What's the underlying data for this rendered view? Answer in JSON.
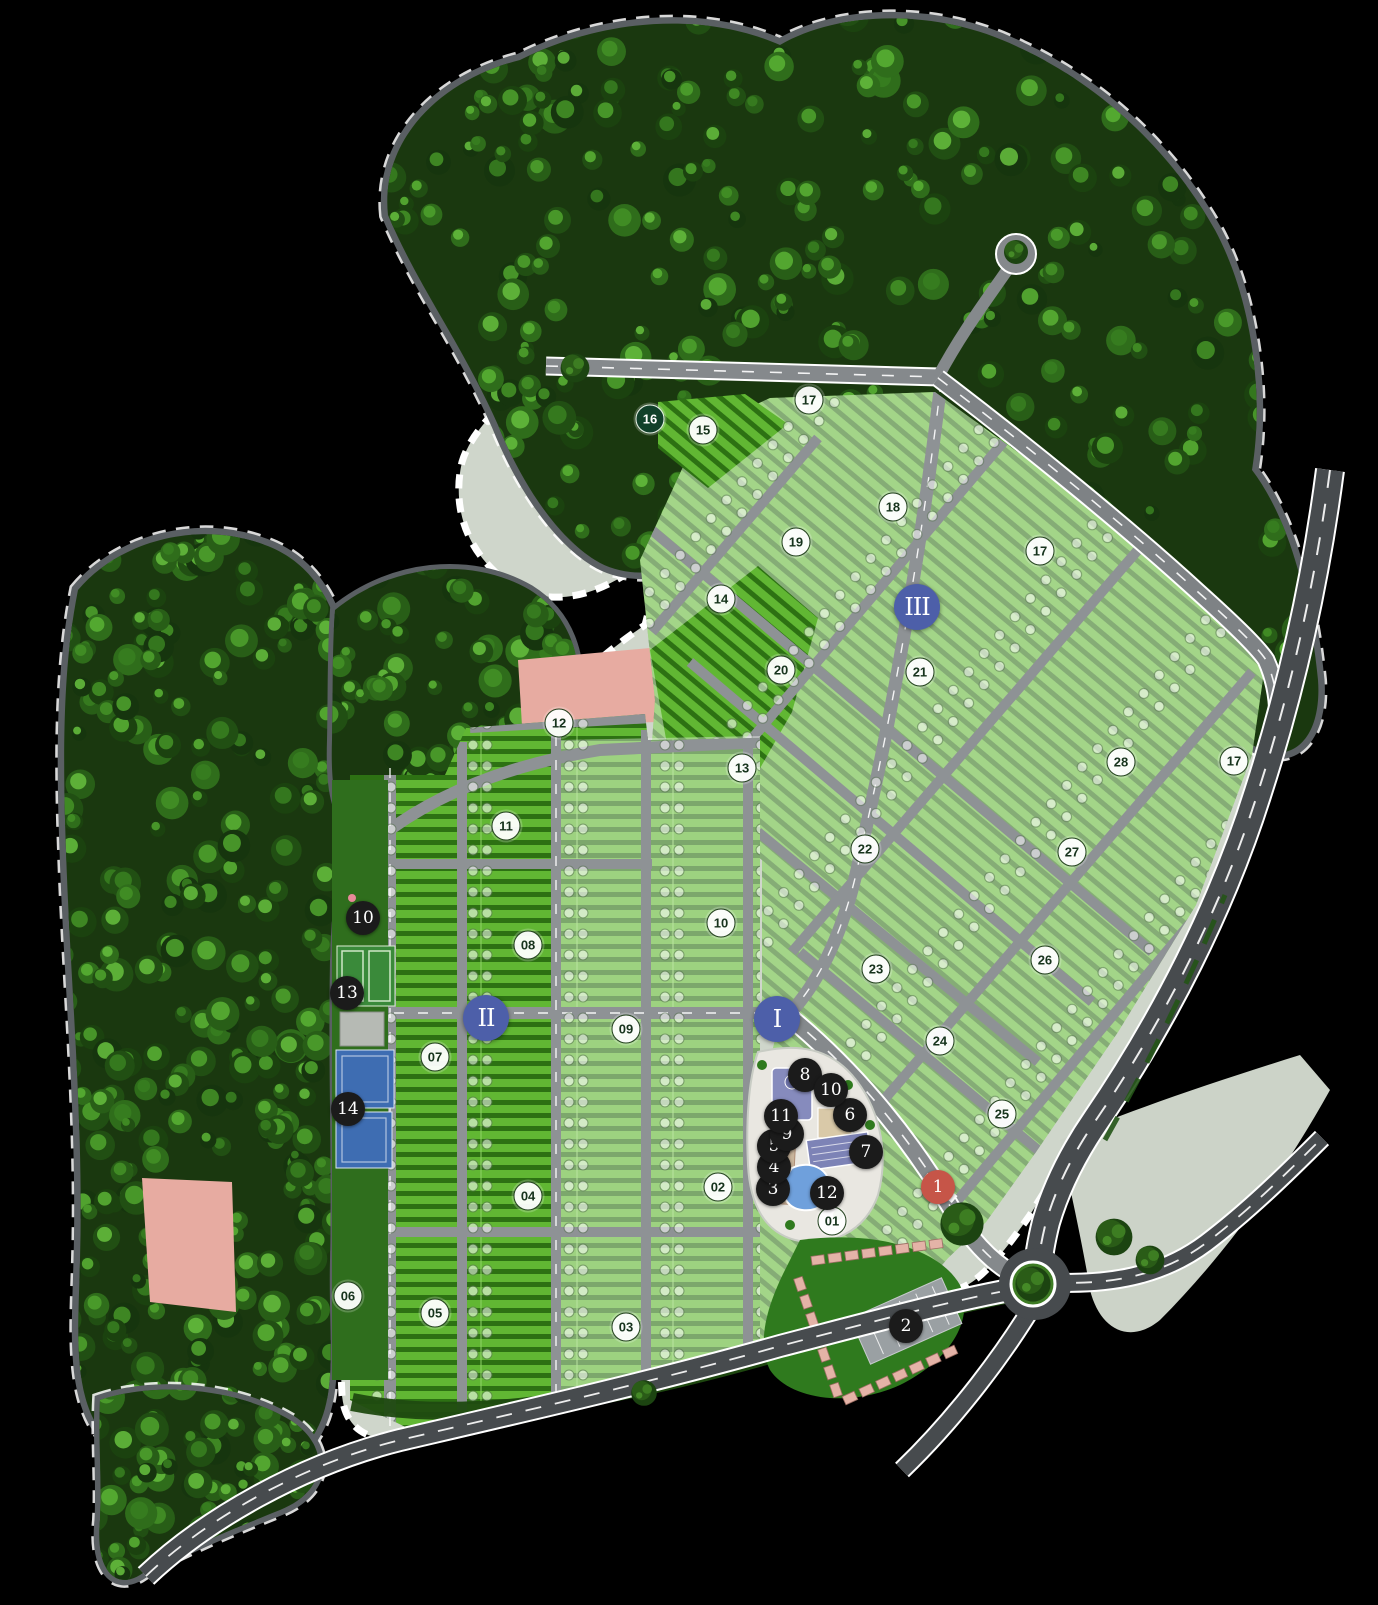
{
  "map": {
    "name": "residential-master-plan",
    "palette": {
      "background": "#000000",
      "forest": "#1a380f",
      "site_base": "#cfd6cb",
      "lot_bright": "#61b733",
      "lot_hedge": "#2d7113",
      "road": "#85898c",
      "highway": "#474b4e",
      "pink_zone": "#e7aba1",
      "phase_marker": "#4d5fa9",
      "amenity_marker": "#1b1b1b",
      "entrance_marker": "#c65548",
      "pool": "#6fa0dc",
      "clubhouse": "#8187ba",
      "court_blue": "#3e6db2",
      "court_green": "#3a8a3a"
    },
    "phase_markers": [
      {
        "label": "I",
        "x": 56.39,
        "y": 63.49
      },
      {
        "label": "II",
        "x": 35.27,
        "y": 63.43
      },
      {
        "label": "III",
        "x": 66.55,
        "y": 37.82
      }
    ],
    "block_markers": [
      {
        "label": "01",
        "x": 60.38,
        "y": 76.07
      },
      {
        "label": "02",
        "x": 52.1,
        "y": 73.96
      },
      {
        "label": "03",
        "x": 45.43,
        "y": 82.68
      },
      {
        "label": "04",
        "x": 38.32,
        "y": 74.52
      },
      {
        "label": "05",
        "x": 31.57,
        "y": 81.81
      },
      {
        "label": "06",
        "x": 25.25,
        "y": 80.75
      },
      {
        "label": "07",
        "x": 31.57,
        "y": 65.86
      },
      {
        "label": "08",
        "x": 38.32,
        "y": 58.88
      },
      {
        "label": "09",
        "x": 45.43,
        "y": 64.11
      },
      {
        "label": "10",
        "x": 52.32,
        "y": 57.51
      },
      {
        "label": "11",
        "x": 36.72,
        "y": 51.46
      },
      {
        "label": "12",
        "x": 40.57,
        "y": 45.05
      },
      {
        "label": "13",
        "x": 53.85,
        "y": 47.85
      },
      {
        "label": "14",
        "x": 52.32,
        "y": 37.32
      },
      {
        "label": "15",
        "x": 51.02,
        "y": 26.79
      },
      {
        "label": "16",
        "x": 47.17,
        "y": 26.1,
        "variant": "dark"
      },
      {
        "label": "17",
        "x": 58.71,
        "y": 24.92
      },
      {
        "label": "17",
        "x": 75.47,
        "y": 34.33
      },
      {
        "label": "17",
        "x": 89.55,
        "y": 47.41
      },
      {
        "label": "18",
        "x": 64.8,
        "y": 31.59
      },
      {
        "label": "19",
        "x": 57.76,
        "y": 33.77
      },
      {
        "label": "20",
        "x": 56.68,
        "y": 41.74
      },
      {
        "label": "21",
        "x": 66.76,
        "y": 41.87
      },
      {
        "label": "22",
        "x": 62.77,
        "y": 52.9
      },
      {
        "label": "23",
        "x": 63.57,
        "y": 60.37
      },
      {
        "label": "24",
        "x": 68.21,
        "y": 64.86
      },
      {
        "label": "25",
        "x": 72.71,
        "y": 69.41
      },
      {
        "label": "26",
        "x": 75.83,
        "y": 59.81
      },
      {
        "label": "27",
        "x": 77.79,
        "y": 53.08
      },
      {
        "label": "28",
        "x": 81.35,
        "y": 47.48
      }
    ],
    "amenity_markers": [
      {
        "label": "1",
        "x": 68.07,
        "y": 73.96,
        "variant": "entrance"
      },
      {
        "label": "2",
        "x": 65.75,
        "y": 82.62
      },
      {
        "label": "3",
        "x": 56.1,
        "y": 74.08
      },
      {
        "label": "4",
        "x": 56.17,
        "y": 72.71
      },
      {
        "label": "5",
        "x": 56.17,
        "y": 71.4
      },
      {
        "label": "6",
        "x": 61.68,
        "y": 69.47
      },
      {
        "label": "7",
        "x": 62.84,
        "y": 71.78
      },
      {
        "label": "8",
        "x": 58.42,
        "y": 66.98
      },
      {
        "label": "9",
        "x": 57.11,
        "y": 70.65
      },
      {
        "label": "10",
        "x": 60.3,
        "y": 67.91
      },
      {
        "label": "11",
        "x": 56.68,
        "y": 69.53
      },
      {
        "label": "12",
        "x": 60.01,
        "y": 74.33
      },
      {
        "label": "10",
        "x": 26.34,
        "y": 57.2
      },
      {
        "label": "13",
        "x": 25.18,
        "y": 61.87
      },
      {
        "label": "14",
        "x": 25.25,
        "y": 69.1
      }
    ]
  }
}
